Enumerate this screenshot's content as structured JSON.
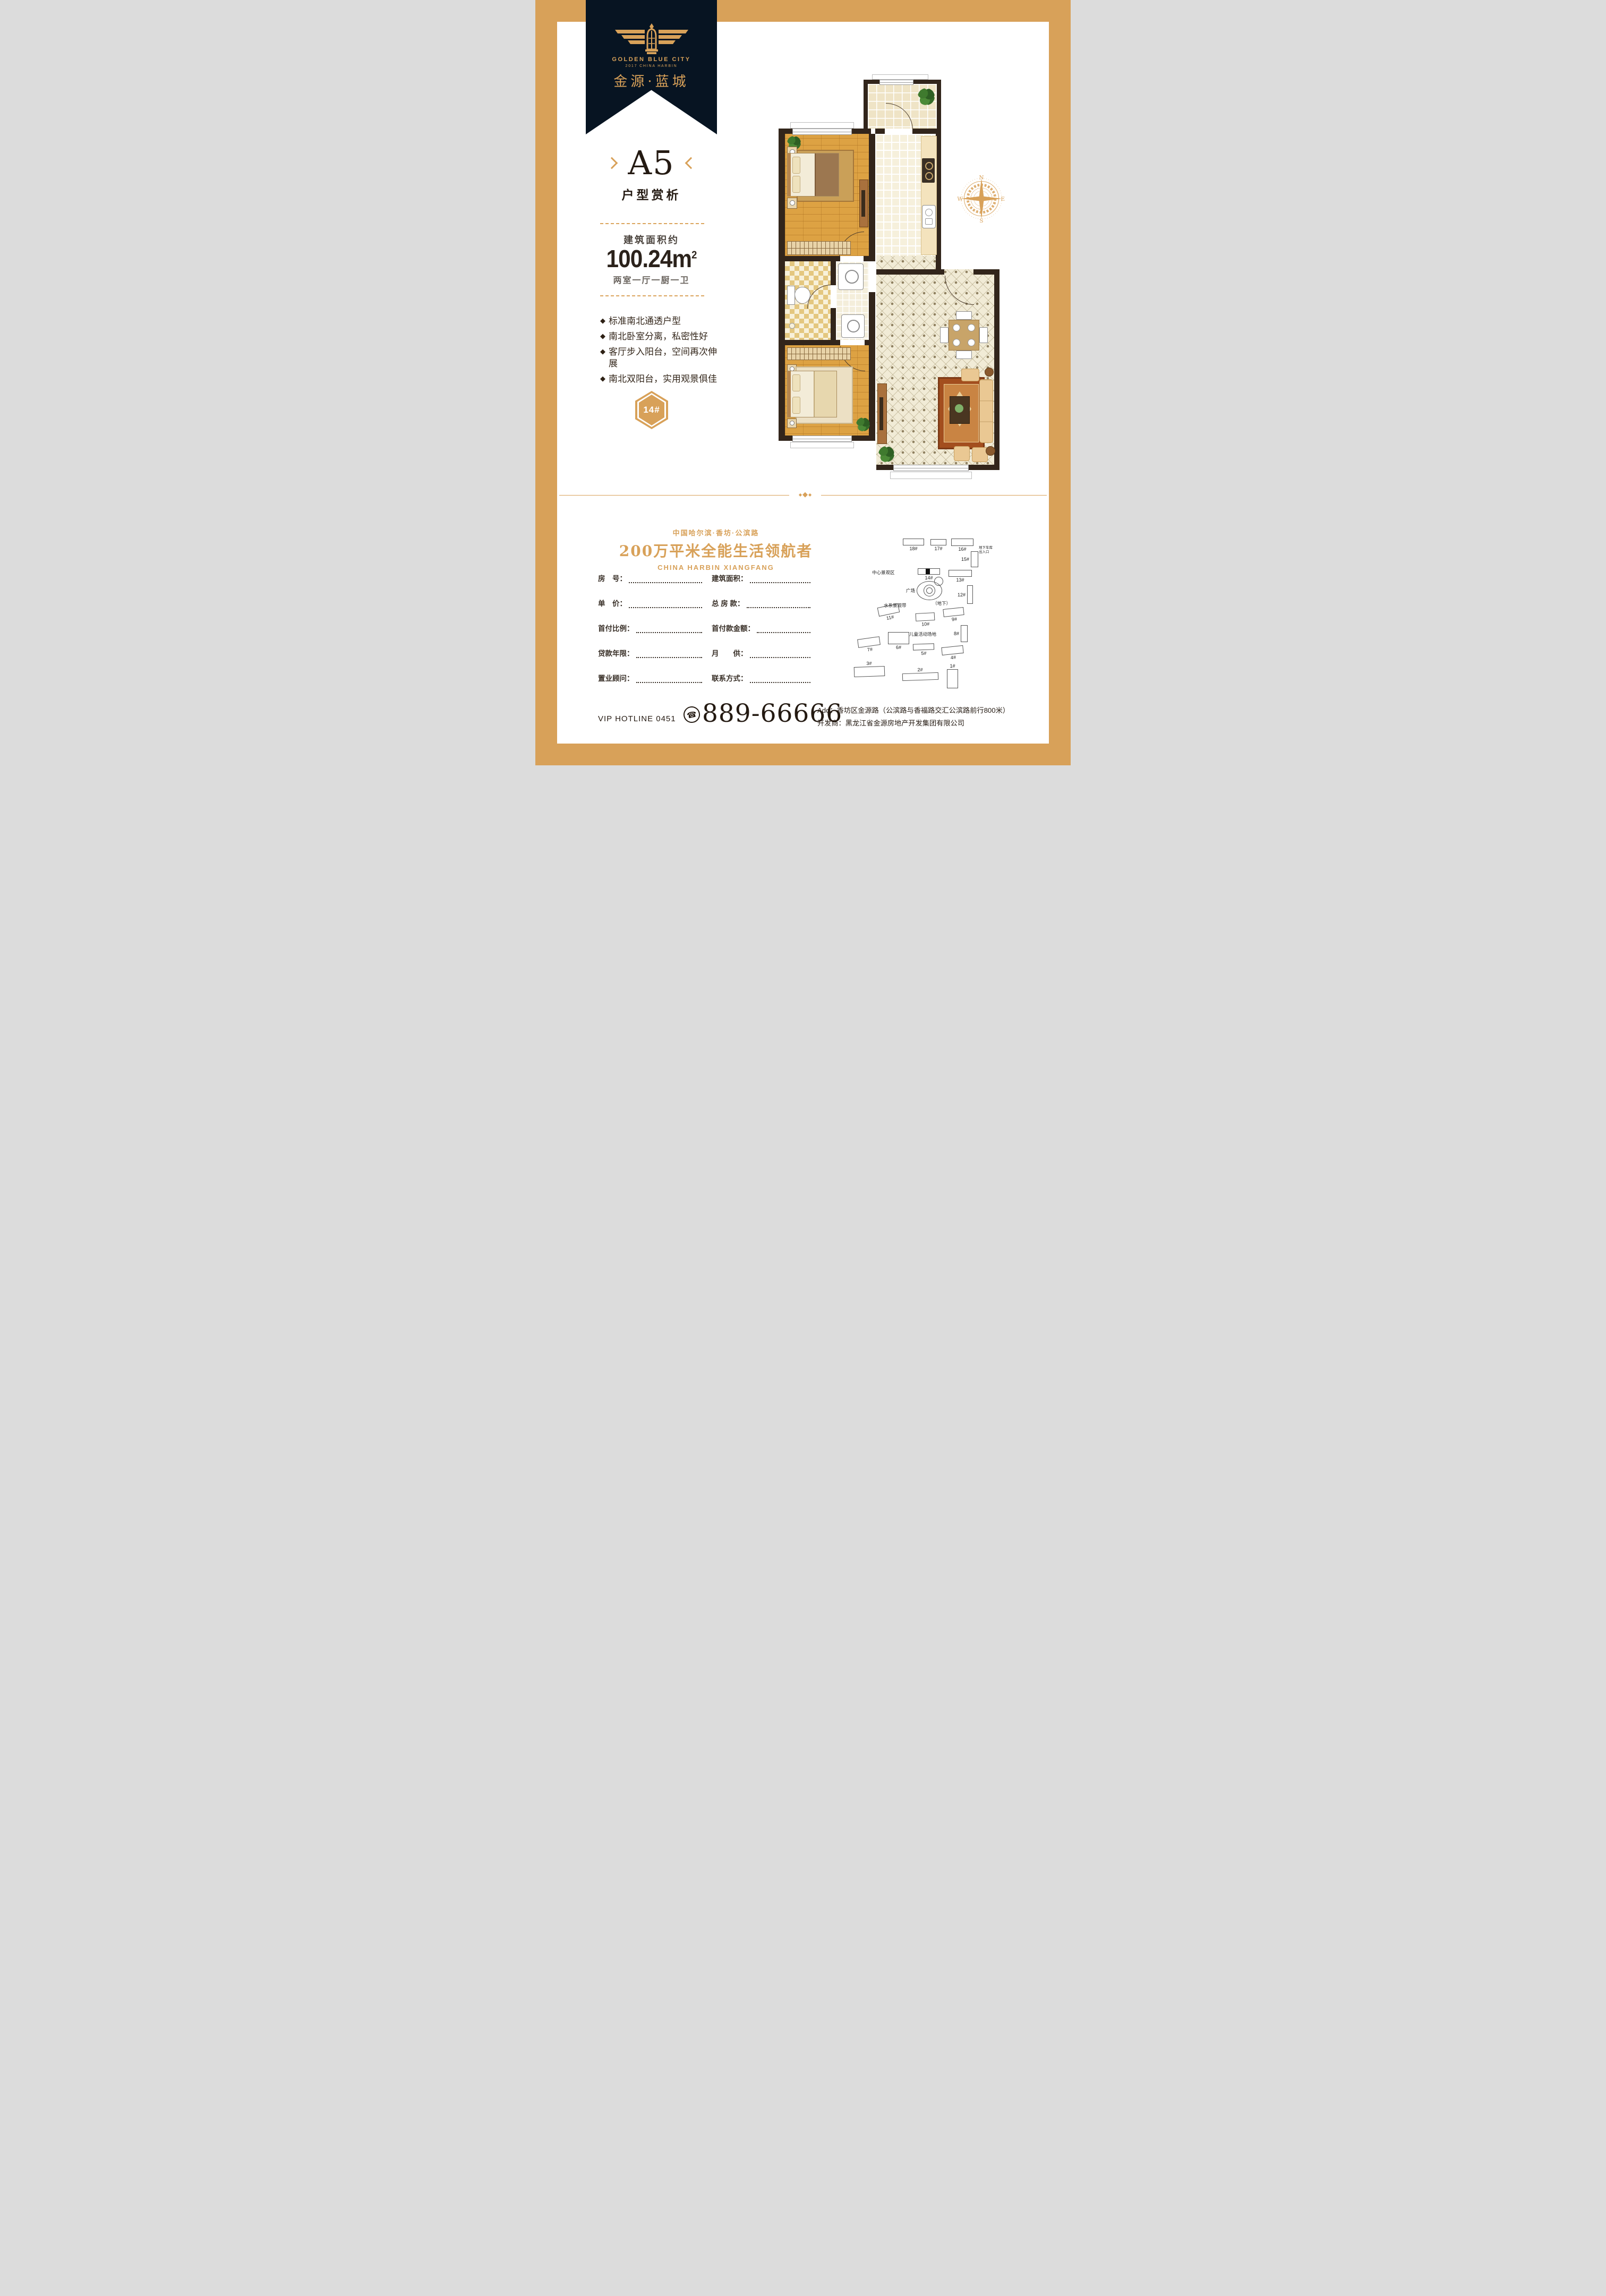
{
  "colors": {
    "gold": "#d8a159",
    "navy": "#071422",
    "ink": "#241a12"
  },
  "ribbon": {
    "logo_title": "GOLDEN BLUE CITY",
    "logo_subtitle": "2017 CHINA HARBIN",
    "brand": "金源·蓝城"
  },
  "unit": {
    "name": "A5",
    "subtitle": "户型赏析",
    "area_label": "建筑面积约",
    "area_value": "100.24m",
    "area_sup": "2",
    "layout": "两室一厅一厨一卫",
    "bullet_icon": "◆",
    "features": [
      "标准南北通透户型",
      "南北卧室分离，私密性好",
      "客厅步入阳台，空间再次伸展",
      "南北双阳台，实用观景俱佳"
    ],
    "badge": "14#"
  },
  "compass": {
    "n": "N",
    "e": "E",
    "s": "S",
    "w": "W"
  },
  "divider": {
    "ornament": "◆"
  },
  "tagline": {
    "line1": "中国哈尔滨·香坊·公滨路",
    "line2": "200万平米全能生活领航者",
    "line3": "CHINA HARBIN XIANGFANG"
  },
  "form": {
    "rows": [
      {
        "left_label": "房　号：",
        "right_label": "建筑面积："
      },
      {
        "left_label": "单　价：",
        "right_label": "总 房 款："
      },
      {
        "left_label": "首付比例：",
        "right_label": "首付款金额："
      },
      {
        "left_label": "贷款年限：",
        "right_label": "月　　供："
      },
      {
        "left_label": "置业顾问：",
        "right_label": "联系方式："
      }
    ]
  },
  "siteplan": {
    "labels": {
      "center_view": "中心景观区",
      "plaza": "广场",
      "underground": "（地下）",
      "water": "水系景观带",
      "children": "儿童活动场地",
      "garage1": "地下车库",
      "garage2": "出入口"
    },
    "buildings": [
      {
        "label": "18#"
      },
      {
        "label": "17#"
      },
      {
        "label": "16#"
      },
      {
        "label": "15#"
      },
      {
        "label": "14#"
      },
      {
        "label": "13#"
      },
      {
        "label": "12#"
      },
      {
        "label": "11#"
      },
      {
        "label": "10#"
      },
      {
        "label": "9#"
      },
      {
        "label": "8#"
      },
      {
        "label": "7#"
      },
      {
        "label": "6#"
      },
      {
        "label": "5#"
      },
      {
        "label": "4#"
      },
      {
        "label": "3#"
      },
      {
        "label": "2#"
      },
      {
        "label": "1#"
      }
    ]
  },
  "footer": {
    "hotline_label": "VIP HOTLINE 0451",
    "phone_icon": "☎",
    "hotline_number": "889-66666",
    "address": "Add：香坊区金源路（公滨路与香福路交汇公滨路前行800米）",
    "developer": "开发商：黑龙江省金源房地产开发集团有限公司"
  },
  "disclaimer": {
    "text": "本户型图及资料仅为示意，非售房合同要约，实际户型及数据以政府批准之建筑图则为准"
  }
}
